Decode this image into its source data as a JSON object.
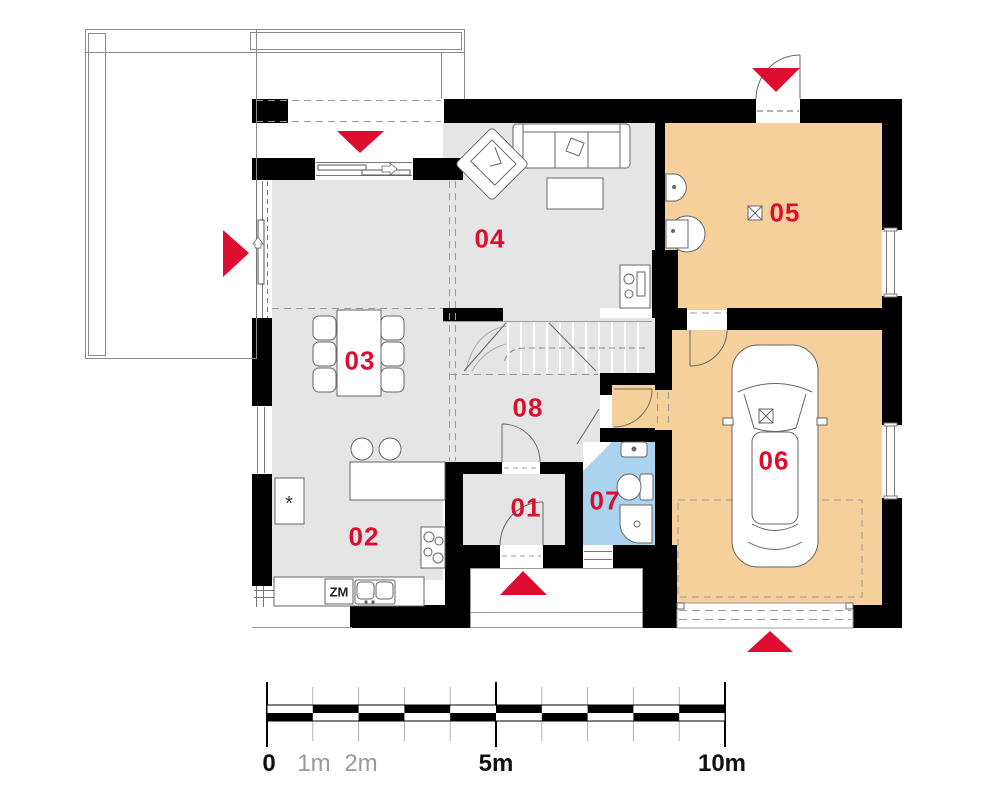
{
  "rooms": [
    {
      "id": "01",
      "label": "01"
    },
    {
      "id": "02",
      "label": "02"
    },
    {
      "id": "03",
      "label": "03"
    },
    {
      "id": "04",
      "label": "04"
    },
    {
      "id": "05",
      "label": "05"
    },
    {
      "id": "06",
      "label": "06"
    },
    {
      "id": "07",
      "label": "07"
    },
    {
      "id": "08",
      "label": "08"
    }
  ],
  "kitchen": {
    "dishwasher_label": "ZM",
    "fridge_symbol": "*"
  },
  "scale_bar": {
    "labels": [
      "0",
      "1m",
      "2m",
      "5m",
      "10m"
    ],
    "total_meters": 10
  },
  "colors": {
    "accent_red": "#dc0d2e",
    "floor_gray": "#e5e5e5",
    "floor_orange": "#f6d09b",
    "floor_blue": "#a9d3ef",
    "wall": "#000000"
  },
  "entrances": [
    {
      "name": "covered-terrace-entrance",
      "direction": "down"
    },
    {
      "name": "terrace-living-entrance",
      "direction": "right"
    },
    {
      "name": "utility-room-entrance",
      "direction": "down"
    },
    {
      "name": "main-entrance",
      "direction": "up"
    },
    {
      "name": "garage-entrance",
      "direction": "up"
    }
  ]
}
